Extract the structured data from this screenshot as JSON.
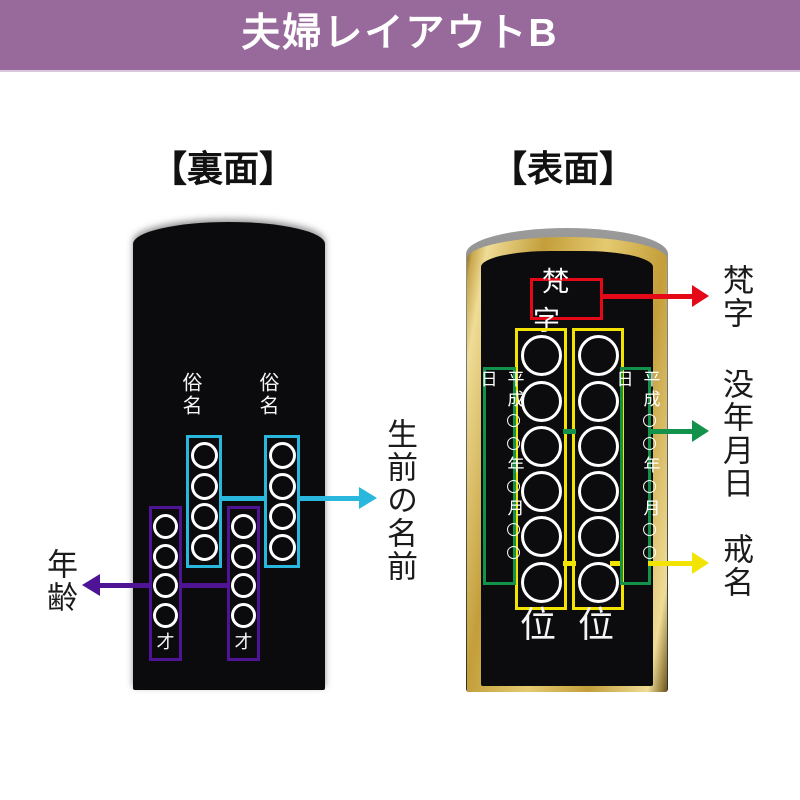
{
  "banner": {
    "title": "夫婦レイアウトB"
  },
  "sections": {
    "back": "【裏面】",
    "front": "【表面】"
  },
  "back_tablet": {
    "common_name_left": "俗名",
    "common_name_right": "俗名",
    "age_suffix_left": "才",
    "age_suffix_right": "才",
    "name_circles_per_box": 4,
    "age_circles_per_box": 4
  },
  "front_tablet": {
    "bonji": "梵字",
    "date_left": "平成○○年○月○○日",
    "date_right": "平成○○年○月○○日",
    "rank_left": "位",
    "rank_right": "位",
    "kaimyo_circles_per_box": 6
  },
  "annotations": {
    "lifetime_name": "生前の名前",
    "age": "年齢",
    "bonji": "梵字",
    "death_date": "没年月日",
    "kaimyo": "戒名"
  },
  "colors": {
    "banner_purple": "#98699b",
    "name_cyan": "#2ab7dd",
    "age_purple": "#4f1496",
    "bonji_red": "#e50816",
    "date_green": "#12924a",
    "kaimyo_yellow": "#f2e300",
    "frame_gold": "#d2b05a",
    "tablet_black": "#0b0b0d"
  }
}
